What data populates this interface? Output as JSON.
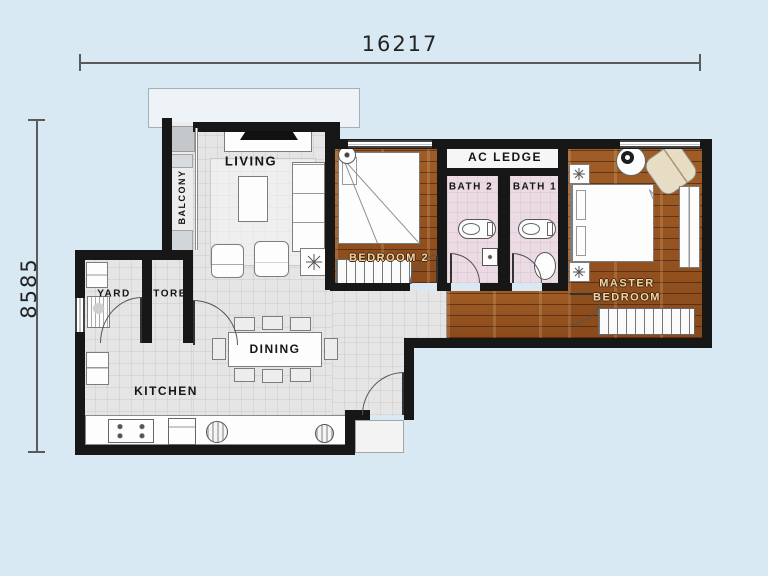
{
  "dimensions": {
    "width": "16217",
    "height": "8585"
  },
  "rooms": {
    "balcony": {
      "label": "BALCONY"
    },
    "living": {
      "label": "LIVING"
    },
    "dining": {
      "label": "DINING"
    },
    "kitchen": {
      "label": "KITCHEN"
    },
    "yard": {
      "label": "YARD"
    },
    "store": {
      "label": "STORE"
    },
    "bedroom2": {
      "label": "BEDROOM 2"
    },
    "ac_ledge": {
      "label": "AC LEDGE"
    },
    "bath1": {
      "label": "BATH 1"
    },
    "bath2": {
      "label": "BATH 2"
    },
    "master_bedroom": {
      "label": "MASTER BEDROOM"
    }
  },
  "colors": {
    "background": "#d9e9f3",
    "wall": "#171717",
    "floor_tile": "#e5e5e5",
    "floor_wood": "#9a5a24",
    "floor_bath": "#ecdbe4",
    "wood_label_text": "#ecd6ab"
  }
}
